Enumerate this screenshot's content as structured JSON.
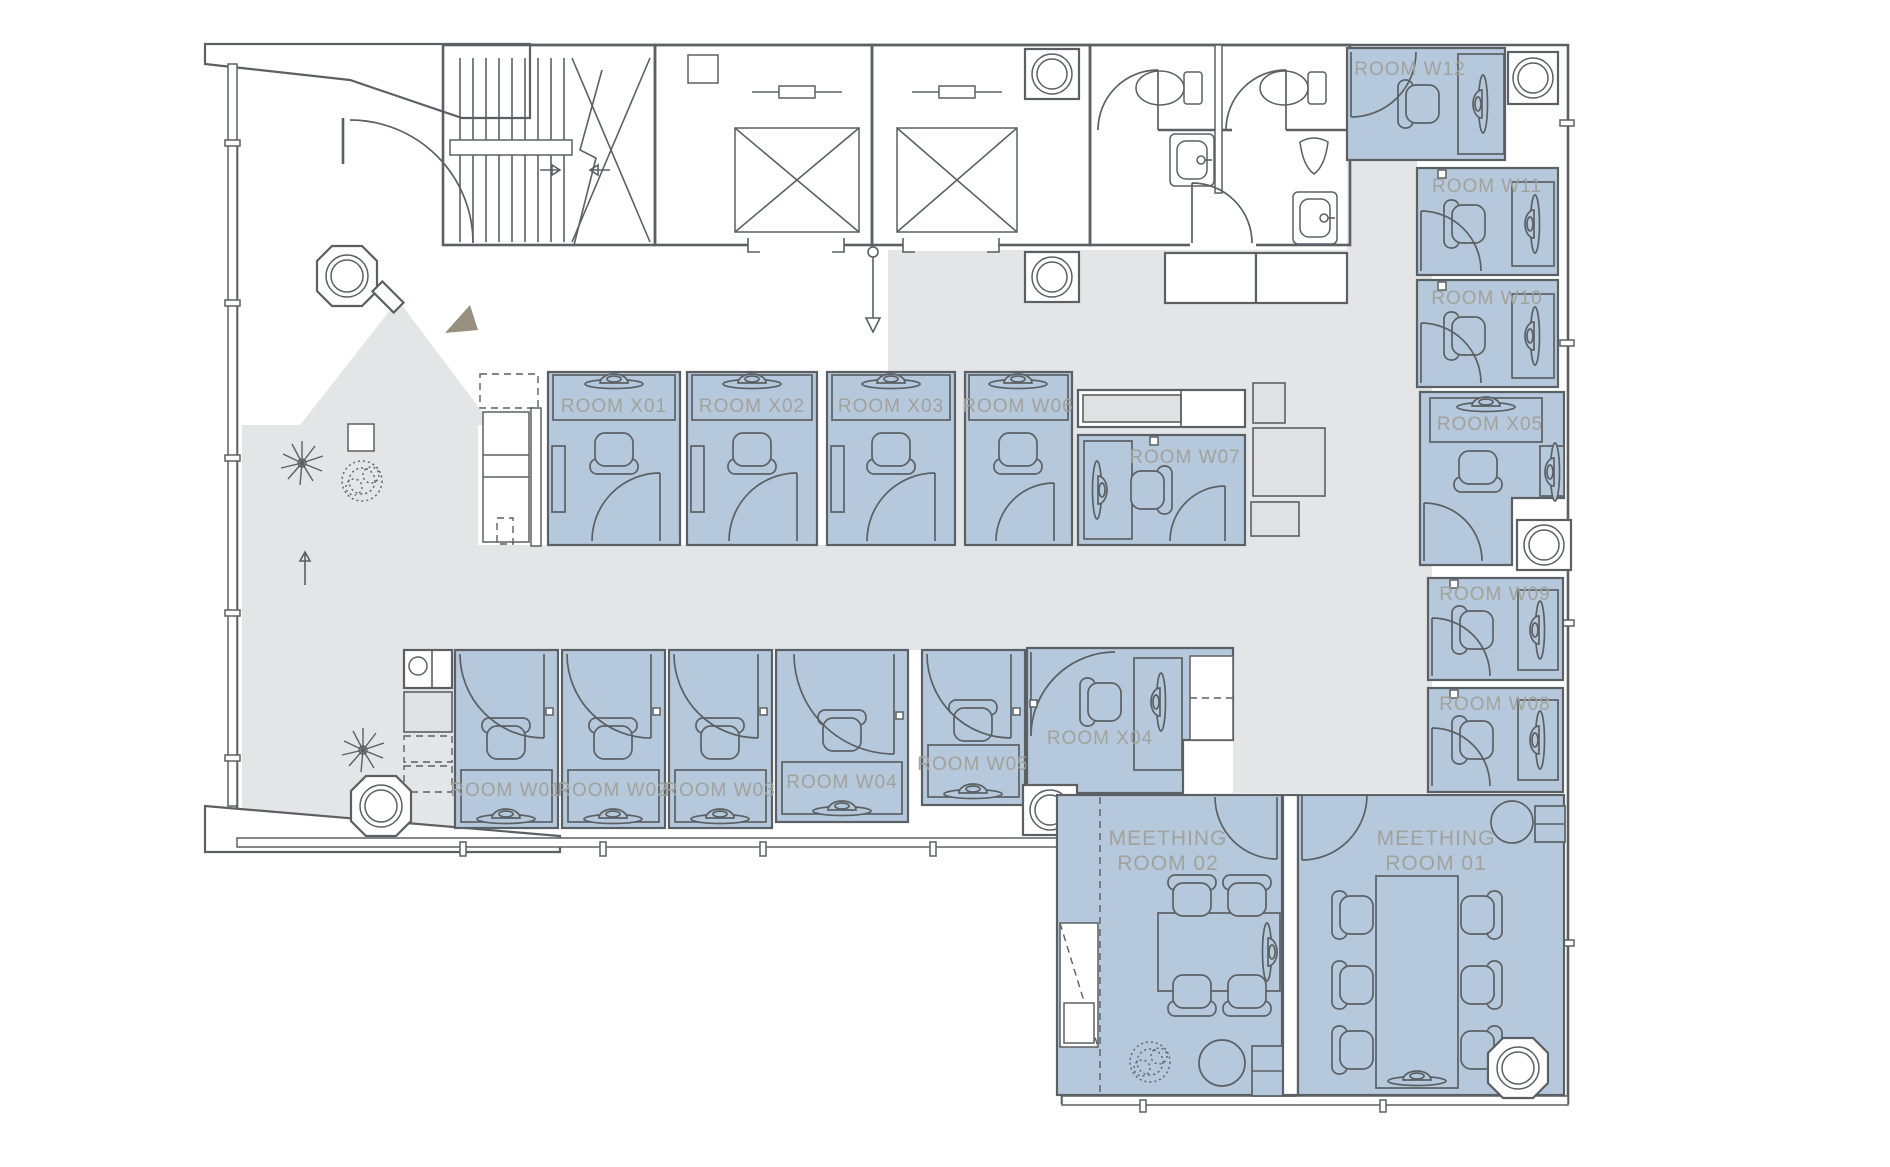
{
  "plan": {
    "rooms": {
      "x01": "ROOM X01",
      "x02": "ROOM X02",
      "x03": "ROOM X03",
      "w06": "ROOM W06",
      "w07": "ROOM W07",
      "w12": "ROOM W12",
      "w11": "ROOM W11",
      "w10": "ROOM W10",
      "x05": "ROOM X05",
      "w09": "ROOM W09",
      "w08": "ROOM W08",
      "w01": "ROOM W01",
      "w02": "ROOM W02",
      "w03": "ROOM W03",
      "w04": "ROOM W04",
      "w05": "ROOM W05",
      "x04": "ROOM X04"
    },
    "meeting_rooms": {
      "m2": {
        "line1": "MEETHING",
        "line2": "ROOM 02"
      },
      "m1": {
        "line1": "MEETHING",
        "line2": "ROOM 01"
      }
    },
    "colors": {
      "room_fill": "#b6c9dc",
      "corridor_fill": "#e4e5e6",
      "wall_stroke": "#5b6064",
      "label_text": "#a1a29c",
      "entry_arrow": "#97907e"
    }
  }
}
